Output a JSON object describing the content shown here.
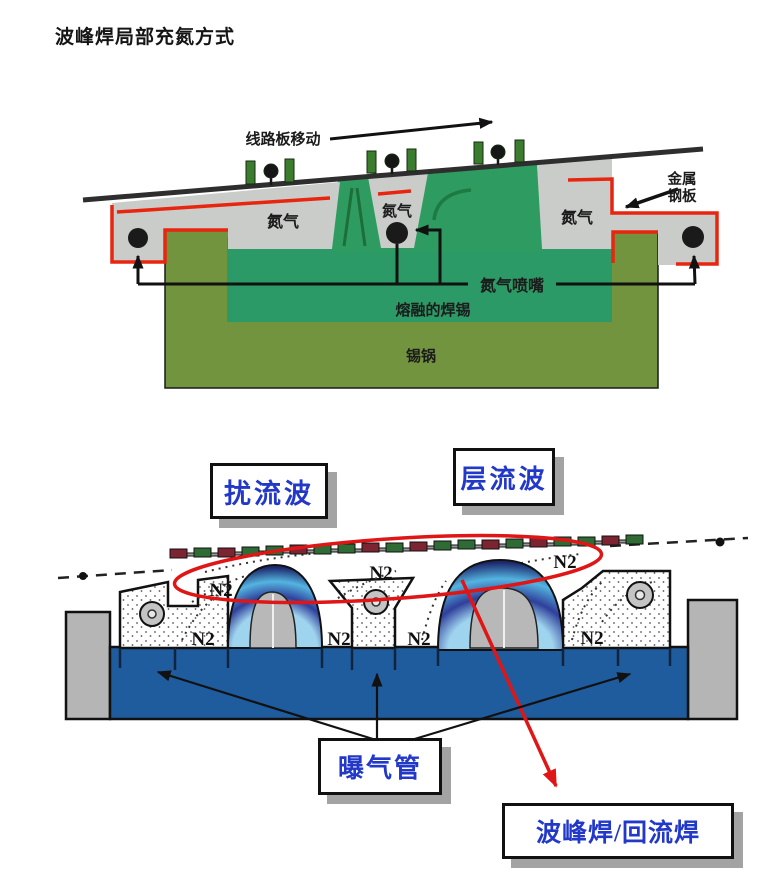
{
  "title": "波峰焊局部充氮方式",
  "top_diagram": {
    "board_move_label": "线路板移动",
    "nitrogen_left": "氮气",
    "nitrogen_center": "氮气",
    "nitrogen_right": "氮气",
    "metal_plate_line1": "金属",
    "metal_plate_line2": "钢板",
    "nozzle_label": "氮气喷嘴",
    "molten_solder_label": "熔融的焊锡",
    "solder_pot_label": "锡锅",
    "colors": {
      "chamber_gray": "#c9ccc9",
      "outline_red": "#e8250f",
      "solder_green": "#2e9c60",
      "pot_olive": "#73943f",
      "pcb_line": "#2e2e2e"
    }
  },
  "bottom_diagram": {
    "turbulent_wave_label": "扰流波",
    "laminar_wave_label": "层流波",
    "aeration_pipe_label": "曝气管",
    "wave_reflow_label": "波峰焊/回流焊",
    "n2_labels": [
      "N2",
      "N2",
      "N2",
      "N2",
      "N2",
      "N2",
      "N2"
    ],
    "colors": {
      "pool_blue": "#1f5c9e",
      "label_blue": "#2238c8",
      "highlight_red": "#e01515",
      "post_gray": "#b5b5b5",
      "wave_blue_light": "#54b4e0",
      "wave_blue_dark": "#1d2a6e"
    }
  }
}
